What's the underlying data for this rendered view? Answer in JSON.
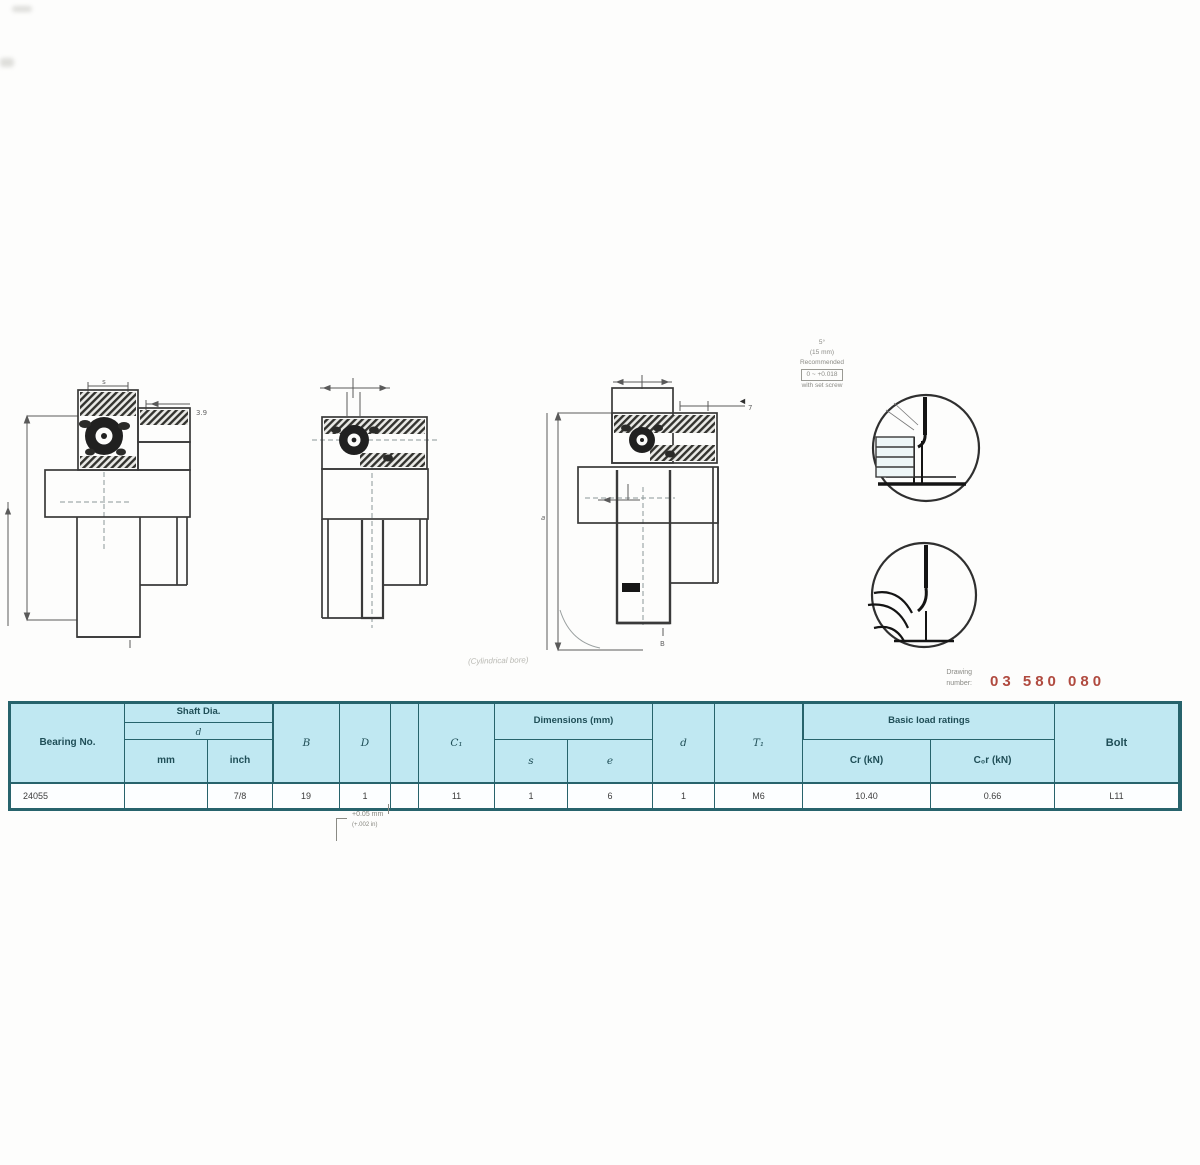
{
  "colors": {
    "table_header_bg": "#c0e8f2",
    "table_border": "#27636c",
    "red_code": "#b04a3f"
  },
  "table": {
    "headers": {
      "bearing": "Bearing No.",
      "shaft_group": "Shaft Dia.",
      "shaft_d": "d",
      "shaft_mm": "mm",
      "shaft_inch": "inch",
      "col_B": "B",
      "col_D": "D",
      "col_blank": "",
      "col_C1": "C₁",
      "mid_group": "Dimensions (mm)",
      "col_s": "s",
      "col_e": "e",
      "col_d": "d",
      "col_T1": "T₁",
      "load_group": "Basic load ratings",
      "load_Cr": "Cr (kN)",
      "load_C0r": "C₀r (kN)",
      "bolt": "Bolt"
    },
    "row": {
      "bearing": "24055",
      "shaft_mm": "",
      "shaft_inch": "7/8",
      "B": "19",
      "D": "1",
      "blank": "",
      "C1": "11",
      "s": "1",
      "e": "6",
      "d": "1",
      "T1": "M6",
      "Cr": "10.40",
      "C0r": "0.66",
      "bolt": "L11"
    }
  },
  "annotations": {
    "detail_note_l1": "5°",
    "detail_note_l2": "(15 mm)",
    "detail_note_l3": "Recommended",
    "detail_note_l4": "0 ~ +0.018",
    "detail_note_l5": "with set screw",
    "leader_arrow": "◄",
    "bore_note": "(Cylindrical bore)",
    "ref_label_l1": "Drawing",
    "ref_label_l2": "number:",
    "ref_code": "03 580 080",
    "footnote_l1": "+0.05 mm",
    "footnote_l2": "(+.002 in)"
  },
  "drawing_labels": {
    "d1_top": "s",
    "d1_side": "3.9",
    "d3_right": "7",
    "d3_left": "a",
    "d3_bottom": "B"
  }
}
